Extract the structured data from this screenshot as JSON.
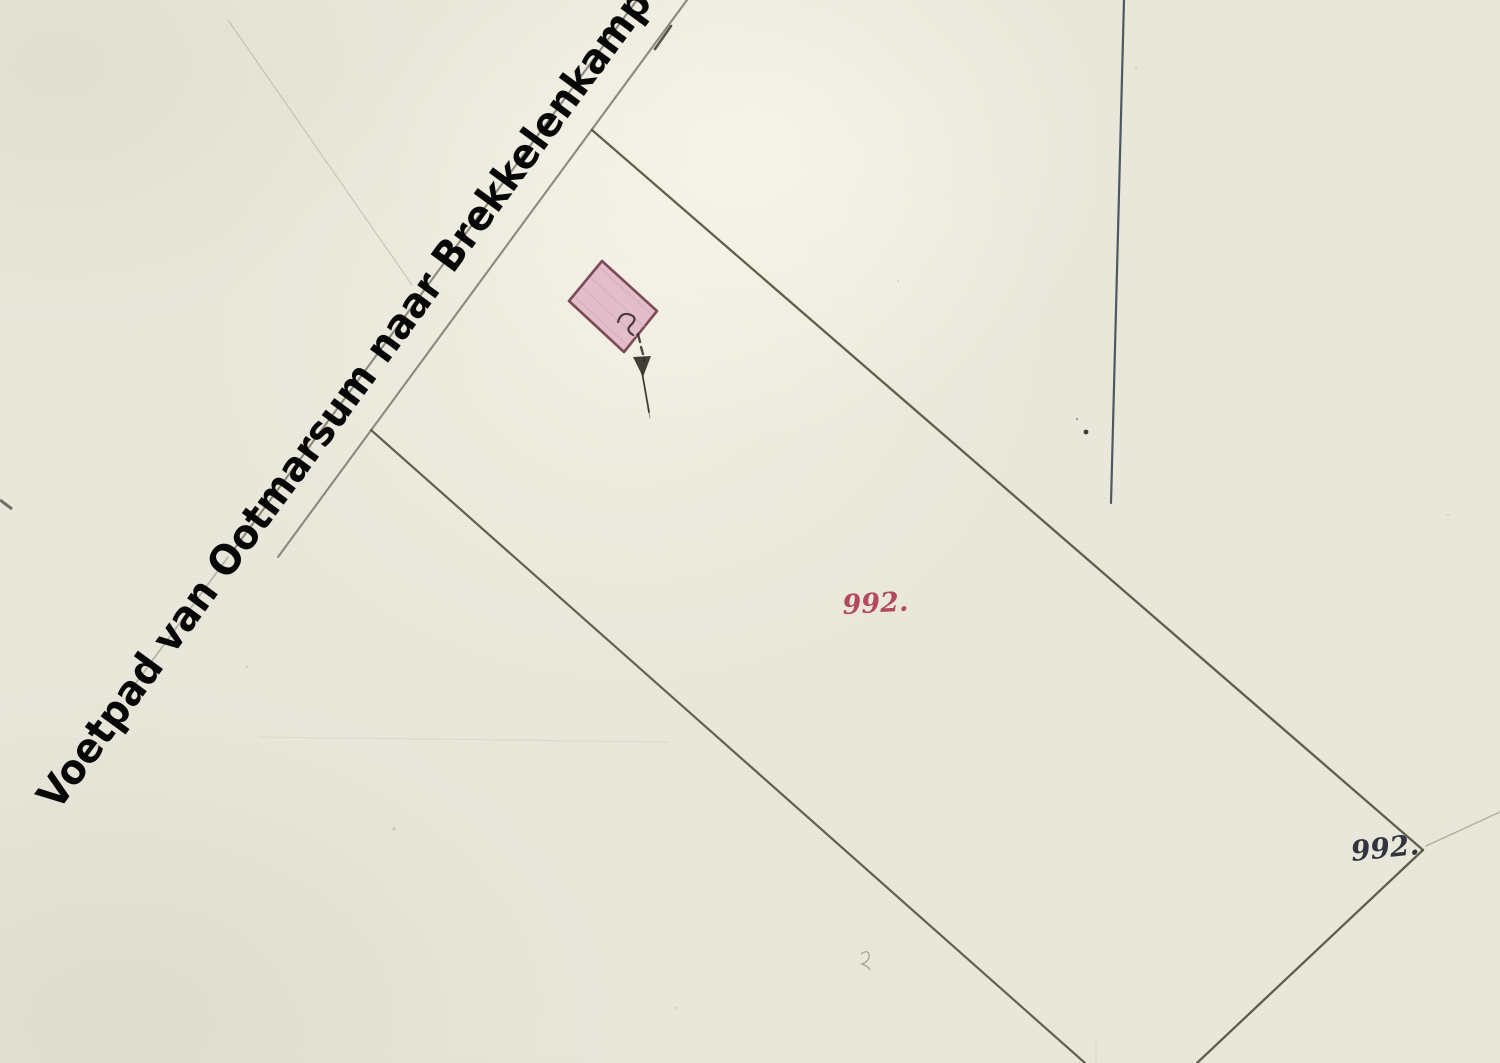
{
  "map": {
    "road_label": "Voetpad van Ootmarsum naar Brekkelenkamp",
    "parcel_number_red": "992.",
    "parcel_number_black": "992.",
    "colors": {
      "paper": "#e9e7da",
      "boundary_line": "#55513f",
      "road_line": "#7a776b",
      "road_label_ink": "#070707",
      "building_fill": "#e3bdc9",
      "building_stroke": "#7d4a57",
      "parcel_label_red": "#b4495b",
      "parcel_label_black": "#30343f",
      "survey_line_blue": "#3e4956",
      "annotation_ink": "#2e2b26"
    }
  }
}
